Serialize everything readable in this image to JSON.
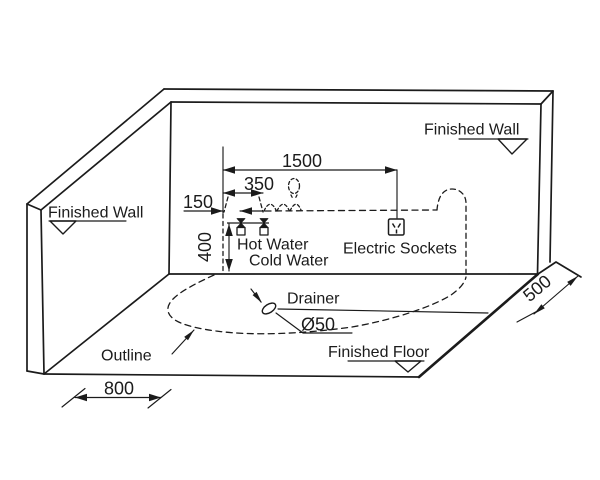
{
  "labels": {
    "finished_wall_left": "Finished Wall",
    "finished_wall_right": "Finished Wall",
    "finished_floor": "Finished Floor",
    "outline": "Outline",
    "drainer": "Drainer",
    "drain_diameter": "Ø50",
    "hot_water": "Hot Water",
    "cold_water": "Cold Water",
    "electric_sockets": "Electric Sockets"
  },
  "dimensions": {
    "sockets_offset": "1500",
    "cold_water_offset": "350",
    "hot_water_offset": "150",
    "taps_height": "400",
    "floor_depth_right": "500",
    "floor_width_front": "800"
  },
  "colors": {
    "ink": "#1b1b1b",
    "background": "#ffffff"
  }
}
